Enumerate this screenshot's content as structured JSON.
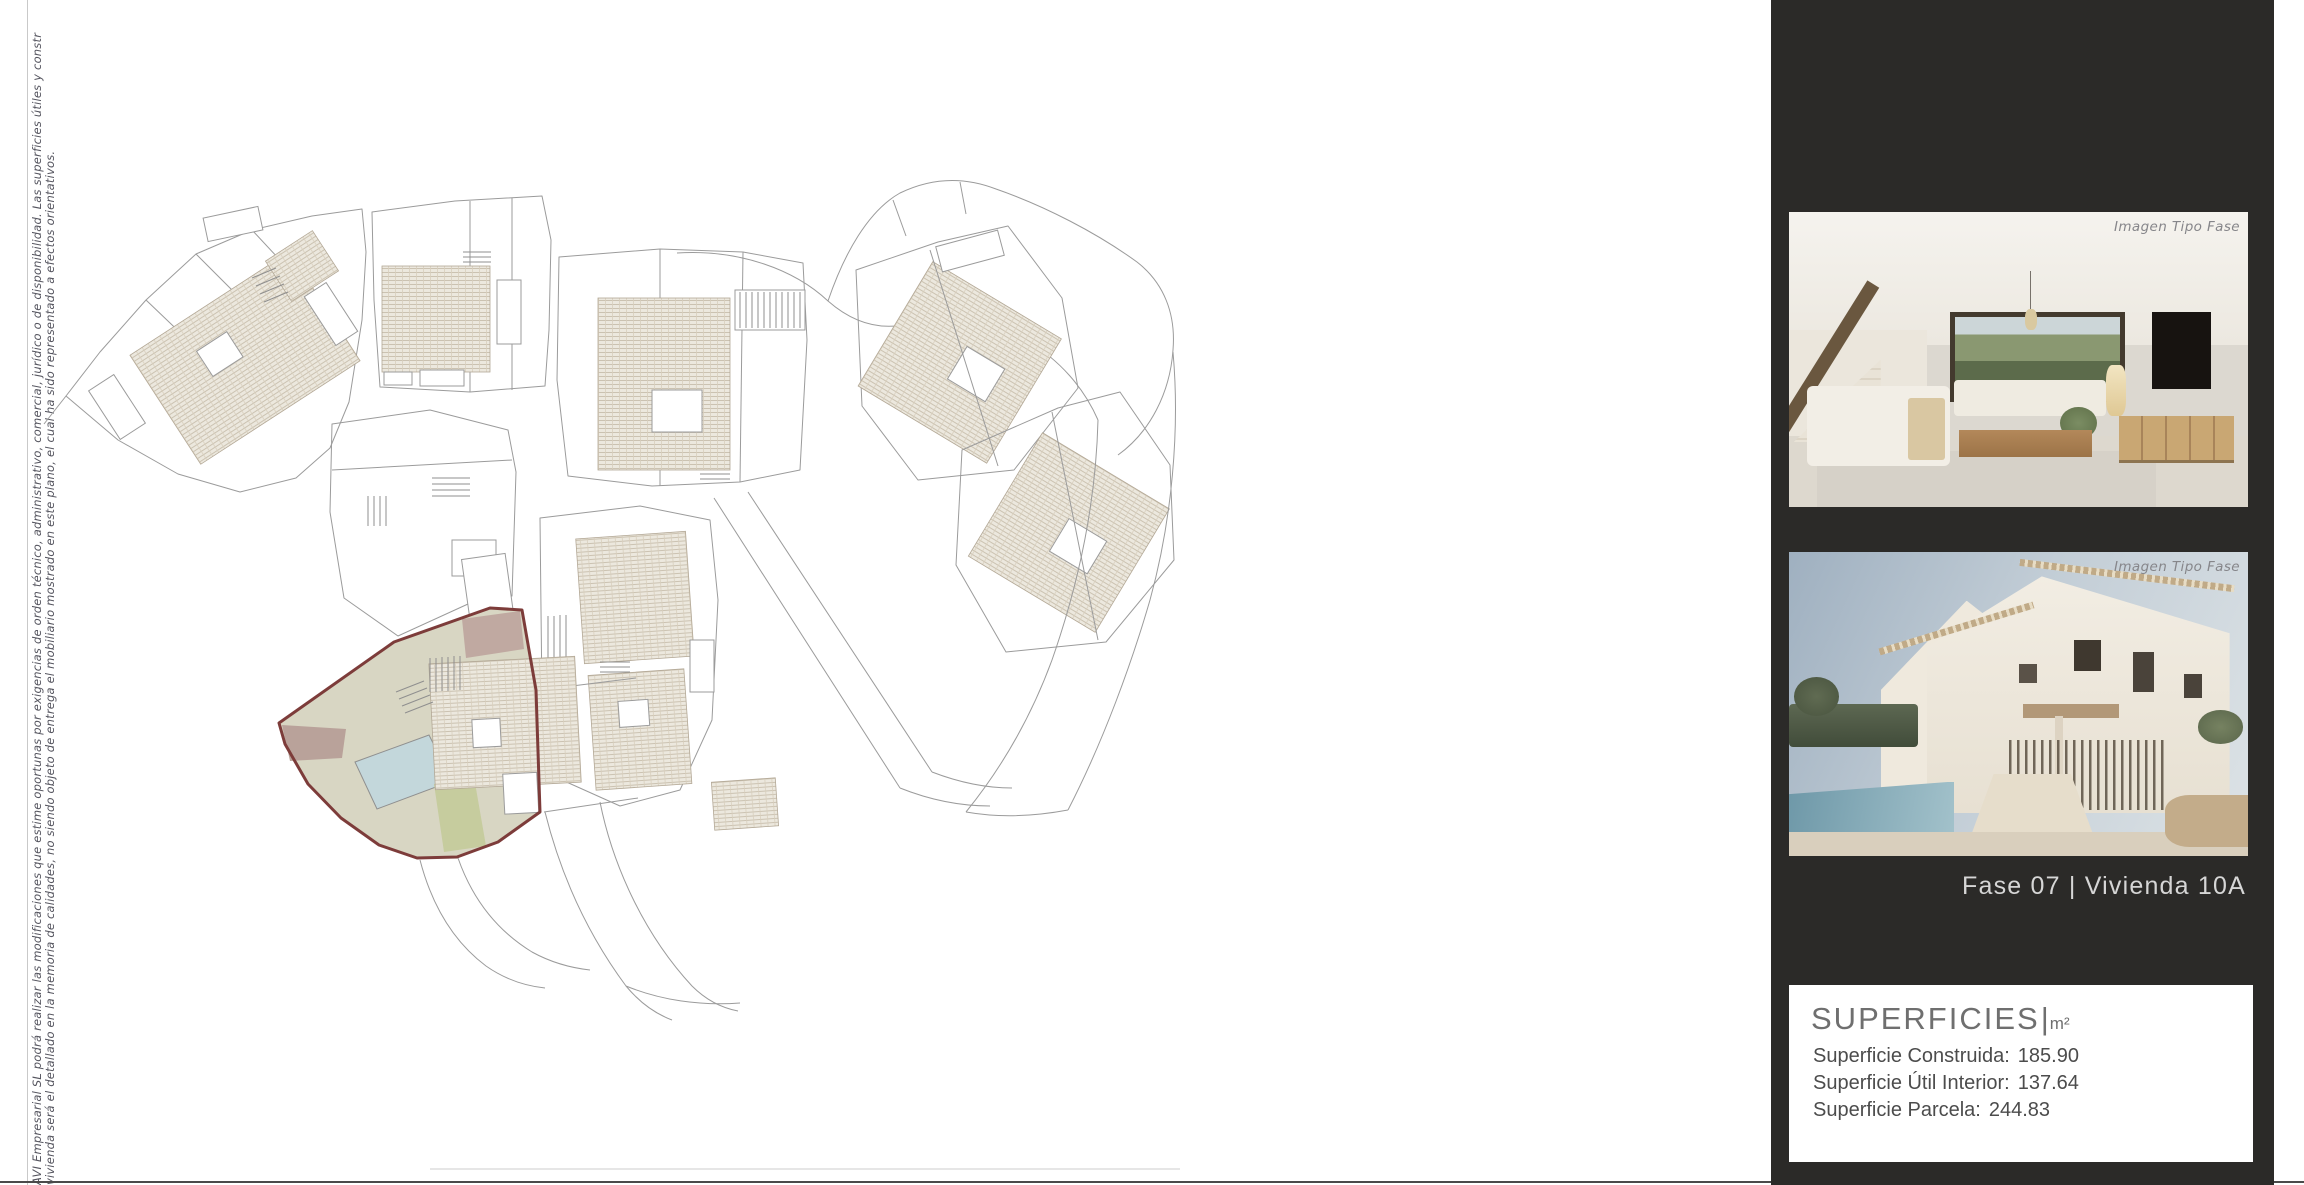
{
  "disclaimer": {
    "line1": "AVI Empresarial SL podrá realizar las modificaciones que estime oportunas por exigencias de orden técnico, administrativo, comercial, jurídico o de disponibilidad. Las superficies útiles y constr",
    "line2": "vivienda será el detallado en la memoria de calidades, no siendo objeto de entrega el mobiliario mostrado en este  plano, el  cual ha sido representado a efectos orientativos."
  },
  "plan": {
    "colors": {
      "outline_gray": "#9b9b9b",
      "highlight_stroke": "#7d3c3a",
      "highlight_fill": "#d8d6c3",
      "mauve_upper": "#c0a9a1",
      "mauve_left": "#b9a29a",
      "pool_blue": "#c3d7db",
      "olive_green": "#c6cc9e",
      "roof_hatch_bg": "#ece8de",
      "roof_hatch_line": "#c8beac"
    }
  },
  "sidebar": {
    "bg": "#2b2a28",
    "images": [
      {
        "label": "Imagen Tipo Fase",
        "description": "interior-living-room-render"
      },
      {
        "label": "Imagen Tipo Fase",
        "description": "exterior-villa-pool-render"
      }
    ],
    "caption": "Fase 07 |  Vivienda 10A",
    "superficies": {
      "title": "SUPERFICIES",
      "pipe": "|",
      "unit": "m²",
      "rows": [
        {
          "label": "Superficie Construida:",
          "value": "185.90"
        },
        {
          "label": "Superficie Útil Interior:",
          "value": "137.64"
        },
        {
          "label": "Superficie Parcela:",
          "value": "244.83"
        }
      ]
    }
  }
}
